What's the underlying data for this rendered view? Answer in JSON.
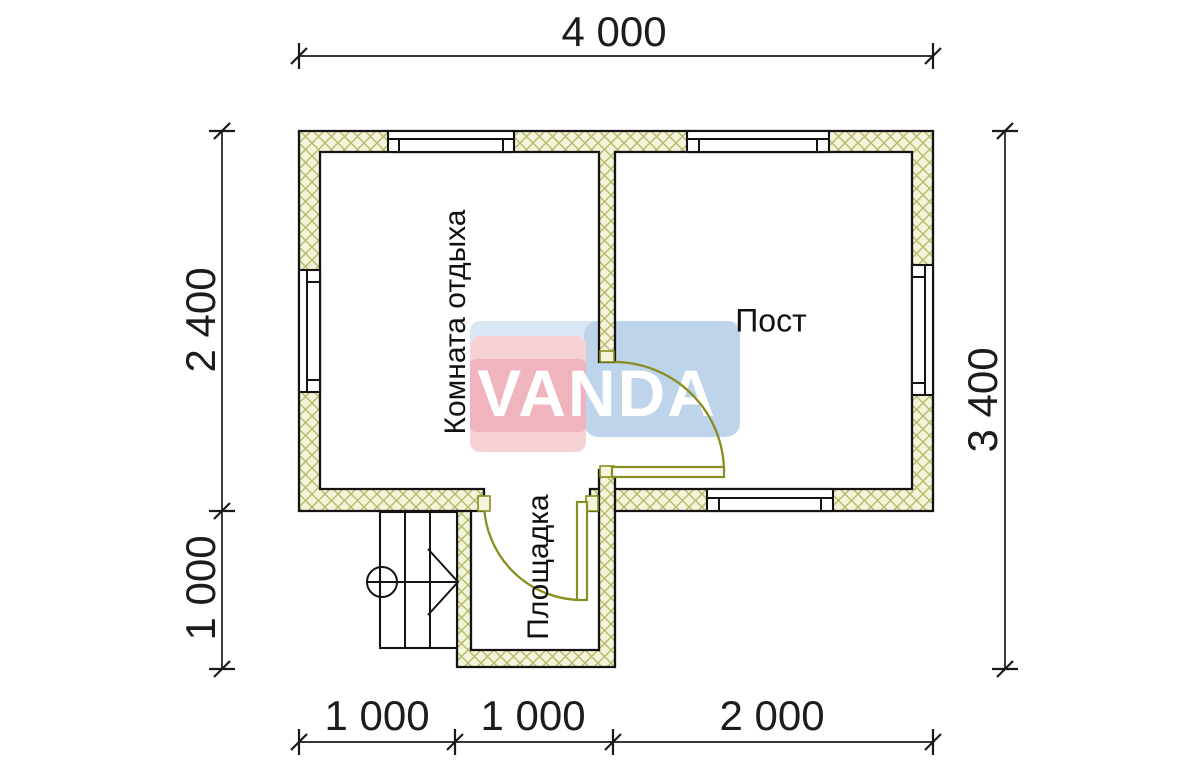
{
  "watermark": {
    "text": "VANDA"
  },
  "rooms": [
    {
      "name": "Комната отдыха"
    },
    {
      "name": "Пост"
    },
    {
      "name": "Площадка"
    }
  ],
  "dimensions": {
    "top": "4 000",
    "bottom": [
      "1 000",
      "1 000",
      "2 000"
    ],
    "left": [
      "2 400",
      "1 000"
    ],
    "right": "3 400"
  },
  "colors": {
    "wall_fill": "#f3f4da",
    "wall_hatch": "#b7ba6a",
    "outline": "#141414",
    "dim_line": "#1a1a1a",
    "door": "#8a8d1f",
    "wm_blue": "#bed4eb",
    "wm_blue_light": "#dae7f4",
    "wm_red": "#efb4bd",
    "wm_red_light": "#f6d2d7"
  }
}
